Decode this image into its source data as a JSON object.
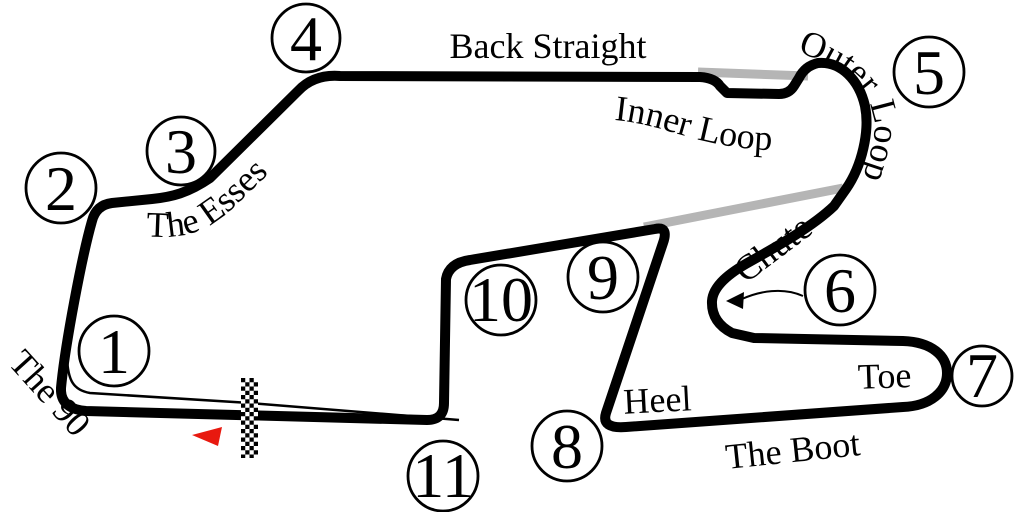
{
  "map": {
    "type": "race-track-circuit-map",
    "start_finish": "checkered start/finish strip",
    "direction": "arrow points left along front straight"
  },
  "turns": [
    "1",
    "2",
    "3",
    "4",
    "5",
    "6",
    "7",
    "8",
    "9",
    "10",
    "11"
  ],
  "labels": {
    "back_straight": "Back Straight",
    "inner_loop": "Inner Loop",
    "outer_loop": "Outer Loop",
    "chute": "Chute",
    "the_esses": "The Esses",
    "the_90": "The 90",
    "toe": "Toe",
    "heel": "Heel",
    "the_boot": "The Boot"
  },
  "colors": {
    "track": "#000000",
    "alternate_route": "#b5b5b5",
    "direction_arrow": "#e8190f",
    "pit_lane": "#000000",
    "background": "#ffffff"
  }
}
